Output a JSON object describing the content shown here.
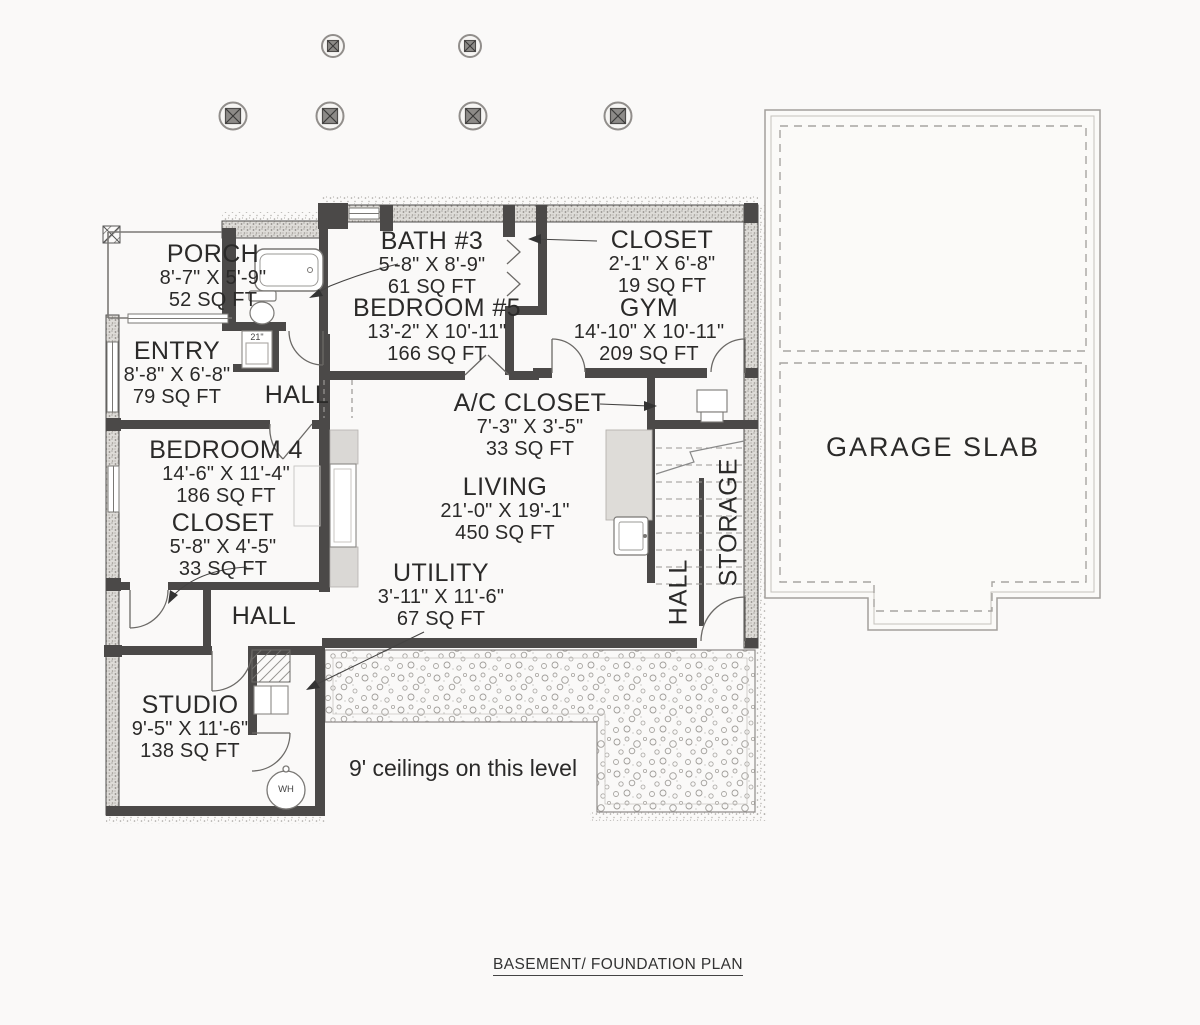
{
  "sheet": {
    "title": "BASEMENT/ FOUNDATION PLAN",
    "ceiling_note": "9' ceilings on this level"
  },
  "garage": {
    "label": "GARAGE SLAB"
  },
  "rooms": [
    {
      "id": "porch",
      "name": "PORCH",
      "dims": "8'-7\" X 5'-9\"",
      "area": "52 SQ FT"
    },
    {
      "id": "bath3",
      "name": "BATH #3",
      "dims": "5'-8\" X 8'-9\"",
      "area": "61 SQ FT"
    },
    {
      "id": "closet-top",
      "name": "CLOSET",
      "dims": "2'-1\" X 6'-8\"",
      "area": "19 SQ FT"
    },
    {
      "id": "bedroom5",
      "name": "BEDROOM #5",
      "dims": "13'-2\" X 10'-11\"",
      "area": "166 SQ FT"
    },
    {
      "id": "gym",
      "name": "GYM",
      "dims": "14'-10\" X 10'-11\"",
      "area": "209 SQ FT"
    },
    {
      "id": "entry",
      "name": "ENTRY",
      "dims": "8'-8\" X 6'-8\"",
      "area": "79 SQ FT"
    },
    {
      "id": "ac-closet",
      "name": "A/C CLOSET",
      "dims": "7'-3\" X 3'-5\"",
      "area": "33 SQ FT"
    },
    {
      "id": "bedroom4",
      "name": "BEDROOM 4",
      "dims": "14'-6\" X 11'-4\"",
      "area": "186 SQ FT"
    },
    {
      "id": "closet4",
      "name": "CLOSET",
      "dims": "5'-8\" X 4'-5\"",
      "area": "33 SQ FT"
    },
    {
      "id": "living",
      "name": "LIVING",
      "dims": "21'-0\" X 19'-1\"",
      "area": "450 SQ FT"
    },
    {
      "id": "utility",
      "name": "UTILITY",
      "dims": "3'-11\" X 11'-6\"",
      "area": "67 SQ FT"
    },
    {
      "id": "studio",
      "name": "STUDIO",
      "dims": "9'-5\" X 11'-6\"",
      "area": "138 SQ FT"
    }
  ],
  "halls": {
    "upper": "HALL",
    "lower": "HALL",
    "stair": "HALL",
    "storage": "STORAGE"
  },
  "fixtures": {
    "water_heater": "WH",
    "vanity_width": "21\""
  },
  "colors": {
    "wall": "#4b4948",
    "line": "#777572",
    "text": "#2b2a29",
    "stipple": "#a8a5a1",
    "background": "#faf9f8"
  }
}
